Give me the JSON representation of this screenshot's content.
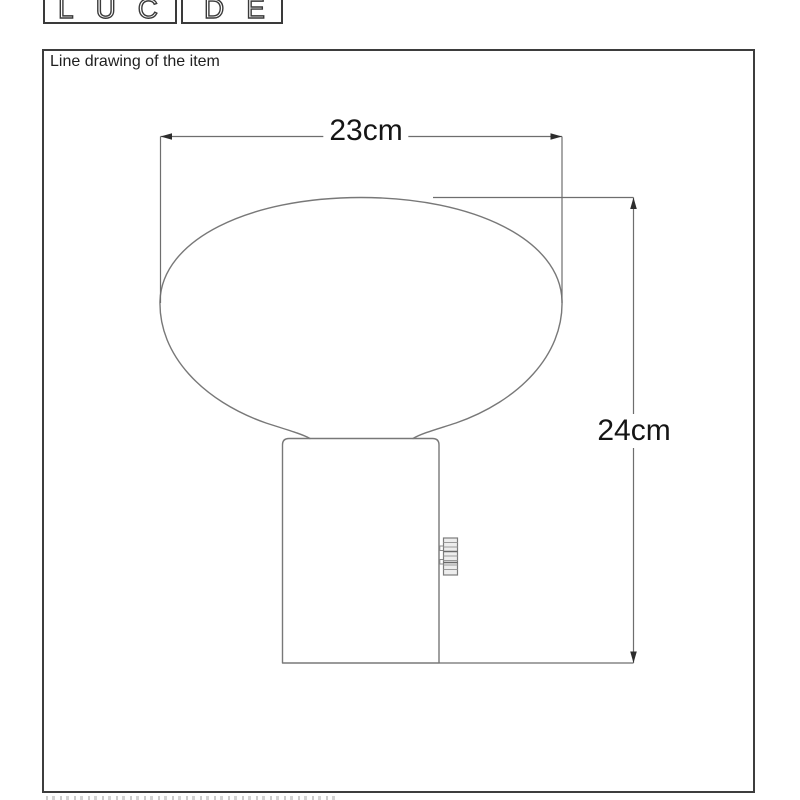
{
  "logo": {
    "left_box_text": "LUC",
    "right_box_text": "DE"
  },
  "panel": {
    "title": "Line drawing of the item"
  },
  "drawing": {
    "subject": "table-lamp-with-oval-shade-and-cylindrical-base",
    "width_dimension": "23cm",
    "height_dimension": "24cm"
  },
  "colors": {
    "background": "#ffffff",
    "frame_border": "#3d3d3d",
    "logo_ink": "#3a3a3a",
    "line": "#787878",
    "dimension_line": "#6e6e6e",
    "arrow": "#2d2d2d",
    "label_text": "#151515"
  }
}
